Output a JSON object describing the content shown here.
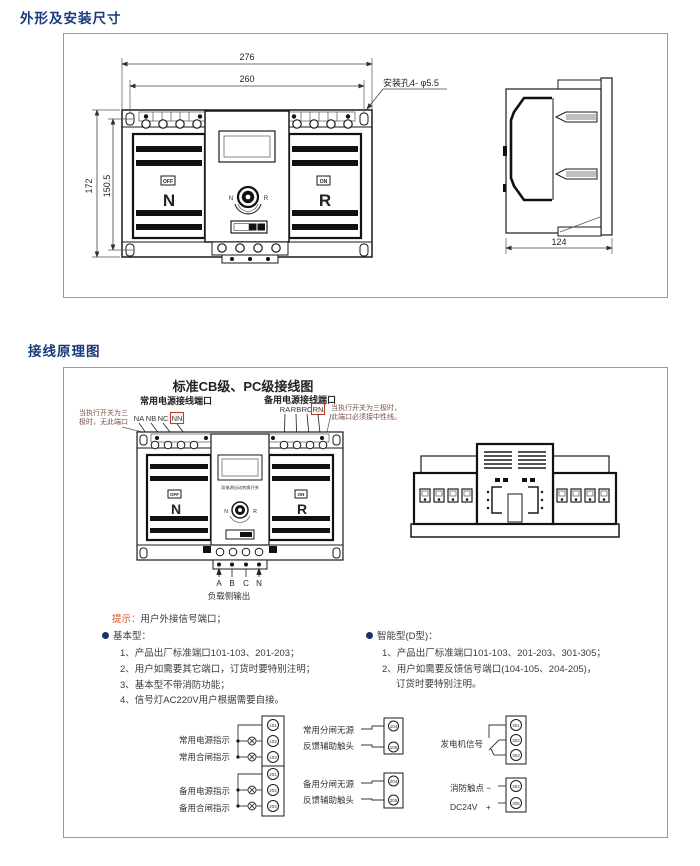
{
  "sections": {
    "outline_title": "外形及安装尺寸",
    "wiring_title": "接线原理图"
  },
  "outline": {
    "front": {
      "dim_width_outer": "276",
      "dim_width_inner": "260",
      "dim_height_outer": "172",
      "dim_height_inner": "150.5",
      "mounting_hole_note": "安装孔4- φ5.5",
      "off_badge": "OFF",
      "on_badge": "ON",
      "normal_label": "N",
      "reserve_label": "R",
      "knob_n": "N",
      "knob_r": "R"
    },
    "side": {
      "dim_depth": "124"
    }
  },
  "wiring_diagram": {
    "title": "标准CB级、PC级接线图",
    "normal_port_title": "常用电源接线端口",
    "reserve_port_title": "备用电源接线端口",
    "normal_terminals": [
      "NA",
      "NB",
      "NC",
      "NN"
    ],
    "reserve_terminals": [
      "RA",
      "RB",
      "RC",
      "RN"
    ],
    "left_note": [
      "当执行开关为三",
      "极时，无此端口"
    ],
    "right_note": [
      "当执行开关为三极时，",
      "此端口必须接中性线。"
    ],
    "device": {
      "off_badge": "OFF",
      "on_badge": "ON",
      "normal_label": "N",
      "reserve_label": "R",
      "knob_n": "N",
      "knob_r": "R",
      "center_text": "双电源自动转换开关"
    },
    "load_terminals": [
      "A",
      "B",
      "C",
      "N"
    ],
    "load_output_label": "负载侧输出"
  },
  "notes": {
    "tip_label": "提示：",
    "tip_text": "用户外接信号端口；",
    "basic_title": "基本型：",
    "basic_items": [
      "1、产品出厂标准端口101-103、201-203；",
      "2、用户如需要其它端口，订货时要特别注明；",
      "3、基本型不带消防功能；",
      "4、信号灯AC220V用户根据需要自接。"
    ],
    "smart_title": "智能型(D型)：",
    "smart_items": [
      "1、产品出厂标准端口101-103、201-203、301-305；",
      "2、用户如需要反馈信号端口(104-105、204-205)，",
      "订货时要特别注明。"
    ]
  },
  "signals": {
    "group1": {
      "line1": "常用电源指示",
      "line2": "常用合闸指示",
      "t1": "101",
      "t2": "102",
      "t3": "103"
    },
    "group2": {
      "line1": "备用电源指示",
      "line2": "备用合闸指示",
      "t1": "201",
      "t2": "202",
      "t3": "203"
    },
    "group3": {
      "line1": "常用分闸无源",
      "line2": "反馈辅助触头",
      "t1": "104",
      "t2": "105"
    },
    "group4": {
      "line1": "备用分闸无源",
      "line2": "反馈辅助触头",
      "t1": "204",
      "t2": "205"
    },
    "group5": {
      "label": "发电机信号",
      "t1": "301",
      "t2": "302",
      "t3": "303"
    },
    "group6": {
      "line1": "消防触点 −",
      "line2": "DC24V　+",
      "t1": "304",
      "t2": "305"
    }
  },
  "colors": {
    "heading_blue": "#1a3a7e",
    "accent_red": "#c0392b",
    "tip_orange": "#d4502a",
    "bullet_navy": "#1a2f6e"
  }
}
